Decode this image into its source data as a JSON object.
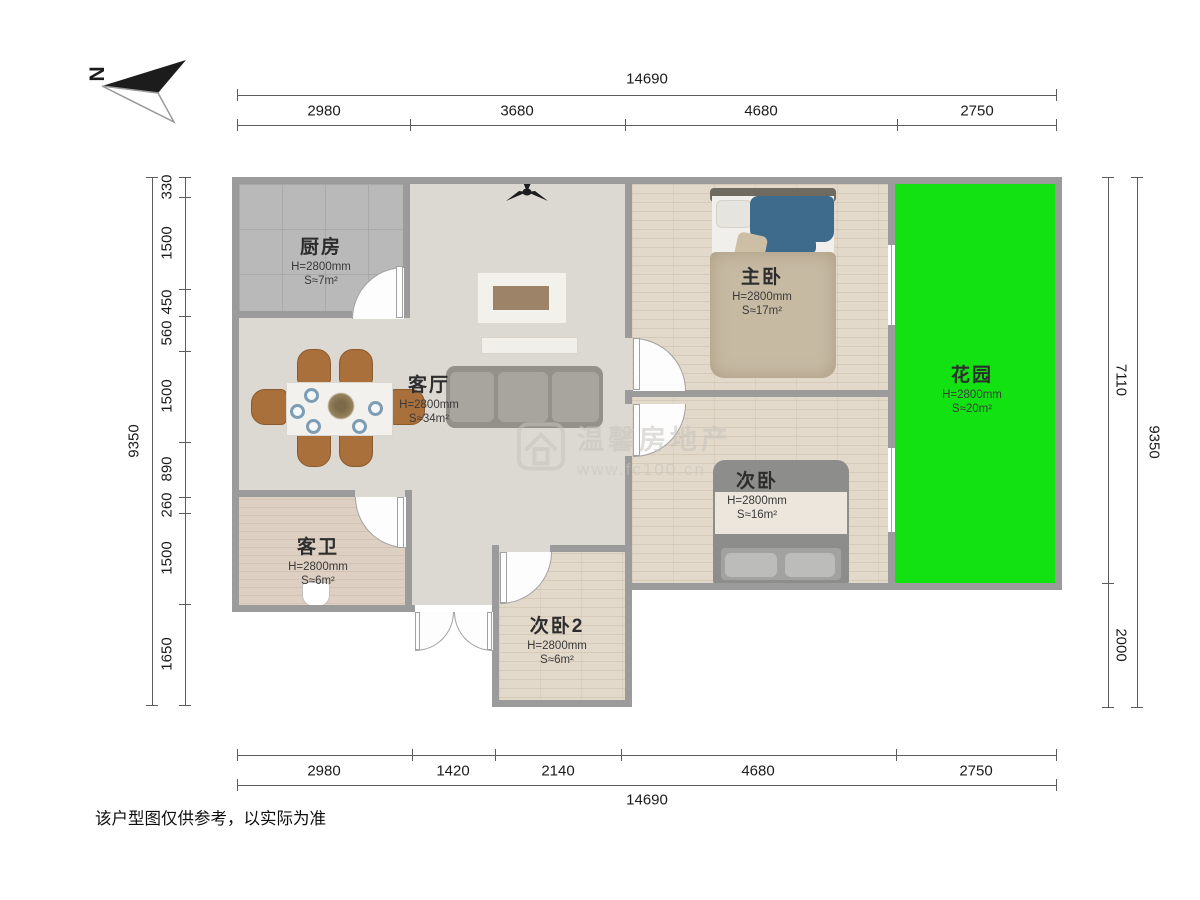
{
  "compass": {
    "label": "N"
  },
  "dimensions": {
    "top": {
      "total": "14690",
      "segments": [
        "2980",
        "3680",
        "4680",
        "2750"
      ]
    },
    "bottom": {
      "total": "14690",
      "segments": [
        "2980",
        "1420",
        "2140",
        "4680",
        "2750"
      ]
    },
    "left": {
      "total": "9350",
      "segments": [
        "330",
        "1500",
        "450",
        "560",
        "1500",
        "890",
        "260",
        "1500",
        "1650"
      ]
    },
    "right": {
      "total": "9350",
      "segments": [
        "7110",
        "2000"
      ]
    }
  },
  "rooms": {
    "kitchen": {
      "name": "厨房",
      "height": "H=2800mm",
      "area": "S≈7m²"
    },
    "living": {
      "name": "客厅",
      "height": "H=2800mm",
      "area": "S≈34m²"
    },
    "master": {
      "name": "主卧",
      "height": "H=2800mm",
      "area": "S≈17m²"
    },
    "second": {
      "name": "次卧",
      "height": "H=2800mm",
      "area": "S≈16m²"
    },
    "second2": {
      "name": "次卧2",
      "height": "H=2800mm",
      "area": "S≈6m²"
    },
    "bath": {
      "name": "客卫",
      "height": "H=2800mm",
      "area": "S≈6m²"
    },
    "garden": {
      "name": "花园",
      "height": "H=2800mm",
      "area": "S≈20m²"
    }
  },
  "watermark": {
    "brand": "温馨房地产",
    "url": "www.fc100.cn"
  },
  "disclaimer": "该户型图仅供参考，以实际为准",
  "colors": {
    "garden_green": "#12E212",
    "wall_gray": "#9B9B9B"
  }
}
